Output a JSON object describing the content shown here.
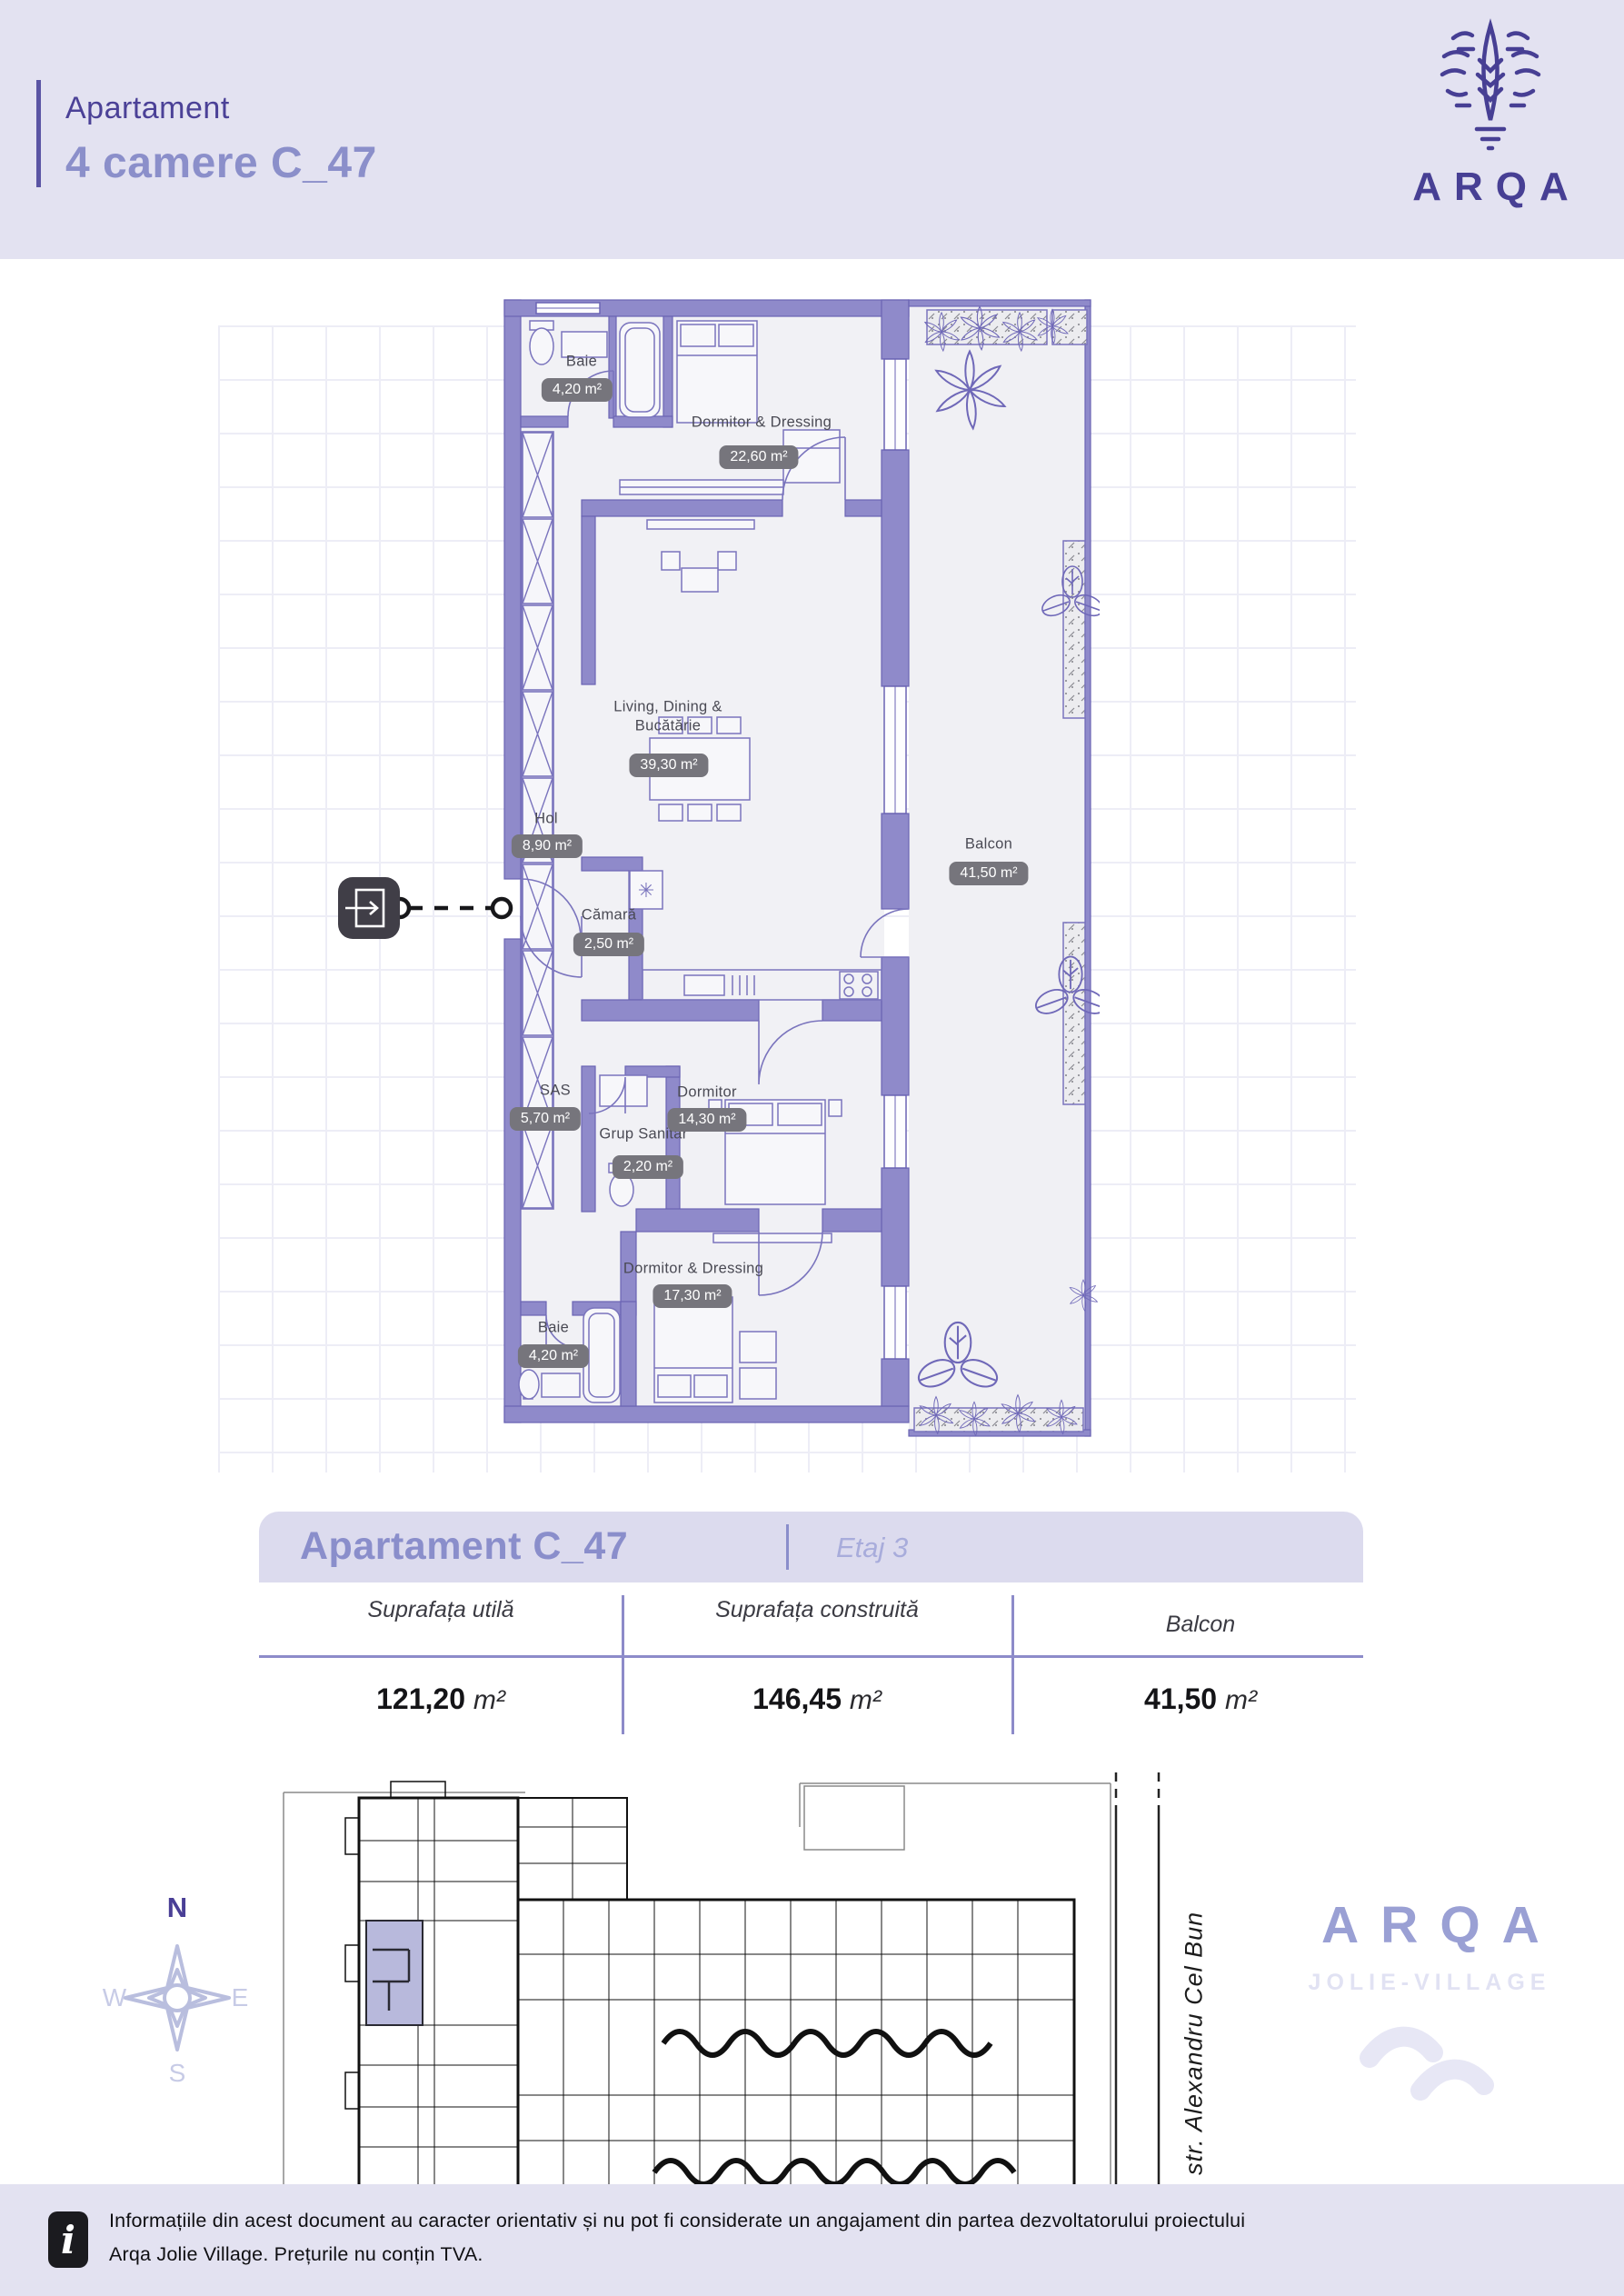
{
  "header": {
    "eyebrow": "Apartament",
    "title": "4 camere C_47",
    "brand": "ARQA"
  },
  "plan": {
    "rooms": [
      {
        "name": "Baie",
        "area": "4,20 m²"
      },
      {
        "name": "Dormitor & Dressing",
        "area": "22,60 m²"
      },
      {
        "name": "Living, Dining & Bucătărie",
        "area": "39,30 m²"
      },
      {
        "name": "Hol",
        "area": "8,90 m²"
      },
      {
        "name": "Cămară",
        "area": "2,50 m²"
      },
      {
        "name": "Balcon",
        "area": "41,50 m²"
      },
      {
        "name": "SAS",
        "area": "5,70 m²"
      },
      {
        "name": "Grup Sanitar",
        "area": "2,20 m²"
      },
      {
        "name": "Dormitor",
        "area": "14,30 m²"
      },
      {
        "name": "Dormitor & Dressing",
        "area": "17,30 m²"
      },
      {
        "name": "Baie",
        "area": "4,20 m²"
      }
    ],
    "fridge_symbol": "✳",
    "wall_color": "#8f8aca",
    "accent_color": "#473f94"
  },
  "summary": {
    "title": "Apartament C_47",
    "floor": "Etaj 3",
    "columns": [
      {
        "label": "Suprafața utilă",
        "value": "121,20",
        "unit": "m²"
      },
      {
        "label": "Suprafața construită",
        "value": "146,45",
        "unit": "m²"
      },
      {
        "label": "Balcon",
        "value": "41,50",
        "unit": "m²"
      }
    ]
  },
  "site": {
    "compass": {
      "n": "N",
      "e": "E",
      "s": "S",
      "w": "W"
    },
    "street": "str. Alexandru Cel Bun",
    "brand": "ARQA",
    "brand_sub": "JOLIE-VILLAGE"
  },
  "footer": {
    "line1": "Informațiile din acest document au caracter orientativ și nu pot fi considerate un angajament din partea dezvoltatorului proiectului",
    "line2": "Arqa Jolie Village. Prețurile nu conțin TVA."
  }
}
